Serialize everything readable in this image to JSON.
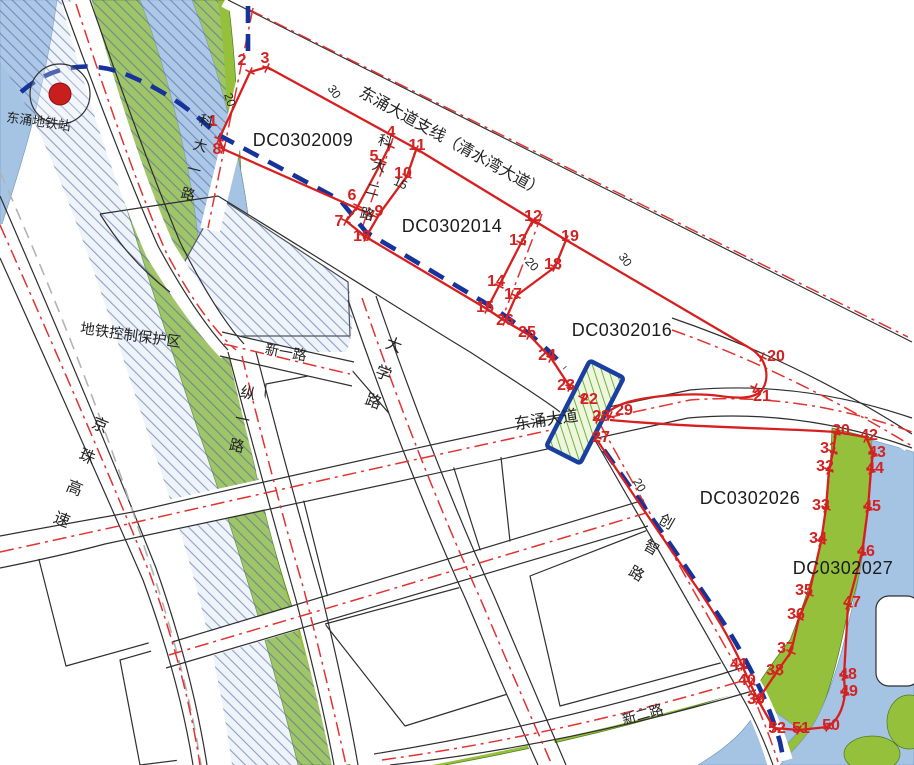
{
  "map_title": "东涌地块规划图",
  "colors": {
    "parcel_boundary_red": "#d81f1f",
    "centerline_red": "#e23232",
    "greenery": "#95c03c",
    "water": "#a5c4e3",
    "metro_blue": "#16339b",
    "hatch_blue": "#3d5a9e",
    "road_edge_black": "#2f2f2f"
  },
  "parcels": [
    {
      "id": "DC0302009",
      "x": 303,
      "y": 140
    },
    {
      "id": "DC0302014",
      "x": 452,
      "y": 226
    },
    {
      "id": "DC0302016",
      "x": 622,
      "y": 330
    },
    {
      "id": "DC0302026",
      "x": 750,
      "y": 498
    },
    {
      "id": "DC0302027",
      "x": 843,
      "y": 568
    }
  ],
  "points": [
    [
      1,
      219,
      139,
      213,
      121
    ],
    [
      2,
      250,
      72,
      242,
      60
    ],
    [
      3,
      267,
      68,
      265,
      58
    ],
    [
      4,
      390,
      146,
      391,
      132
    ],
    [
      5,
      382,
      161,
      374,
      156
    ],
    [
      6,
      358,
      206,
      352,
      195
    ],
    [
      7,
      346,
      221,
      339,
      221
    ],
    [
      8,
      223,
      149,
      217,
      149
    ],
    [
      9,
      372,
      215,
      379,
      211
    ],
    [
      10,
      407,
      176,
      403,
      173
    ],
    [
      11,
      416,
      150,
      417,
      145
    ],
    [
      12,
      533,
      222,
      533,
      216
    ],
    [
      13,
      521,
      243,
      518,
      240
    ],
    [
      14,
      499,
      286,
      496,
      281
    ],
    [
      15,
      487,
      309,
      485,
      307
    ],
    [
      16,
      366,
      237,
      362,
      236
    ],
    [
      17,
      516,
      296,
      513,
      294
    ],
    [
      18,
      555,
      267,
      553,
      264
    ],
    [
      19,
      566,
      240,
      570,
      236
    ],
    [
      20,
      762,
      357,
      776,
      356
    ],
    [
      21,
      755,
      388,
      762,
      396
    ],
    [
      22,
      583,
      398,
      589,
      399
    ],
    [
      23,
      570,
      387,
      566,
      385
    ],
    [
      24,
      551,
      358,
      547,
      355
    ],
    [
      25,
      529,
      335,
      527,
      332
    ],
    [
      26,
      505,
      321,
      505,
      320
    ],
    [
      27,
      597,
      437,
      601,
      437
    ],
    [
      28,
      598,
      419,
      601,
      416
    ],
    [
      29,
      610,
      416,
      624,
      410
    ],
    [
      30,
      836,
      433,
      841,
      430
    ],
    [
      31,
      833,
      452,
      829,
      448
    ],
    [
      32,
      829,
      470,
      825,
      466
    ],
    [
      33,
      826,
      508,
      821,
      505
    ],
    [
      34,
      821,
      542,
      818,
      538
    ],
    [
      35,
      809,
      594,
      804,
      590
    ],
    [
      36,
      799,
      618,
      796,
      614
    ],
    [
      37,
      791,
      652,
      786,
      648
    ],
    [
      38,
      776,
      673,
      775,
      670
    ],
    [
      39,
      758,
      700,
      756,
      699
    ],
    [
      40,
      751,
      683,
      747,
      680
    ],
    [
      41,
      743,
      666,
      739,
      664
    ],
    [
      42,
      866,
      438,
      869,
      435
    ],
    [
      43,
      873,
      454,
      877,
      452
    ],
    [
      44,
      871,
      470,
      875,
      468
    ],
    [
      45,
      868,
      508,
      872,
      506
    ],
    [
      46,
      862,
      553,
      866,
      551
    ],
    [
      47,
      848,
      605,
      852,
      602
    ],
    [
      48,
      844,
      676,
      848,
      674
    ],
    [
      49,
      845,
      693,
      849,
      691
    ],
    [
      50,
      828,
      727,
      831,
      725
    ],
    [
      51,
      799,
      730,
      801,
      728
    ],
    [
      52,
      774,
      728,
      777,
      728
    ]
  ],
  "road_labels_horizontal": [
    {
      "text": "东涌大道支线（清水湾大道）",
      "x": 449,
      "y": 146,
      "rot": 29,
      "size": 16
    },
    {
      "text": "新一路",
      "x": 285,
      "y": 357,
      "rot": 10,
      "size": 14
    },
    {
      "text": "东涌大道",
      "x": 547,
      "y": 425,
      "rot": -8,
      "size": 16
    },
    {
      "text": "新二路",
      "x": 644,
      "y": 719,
      "rot": -16,
      "size": 14
    },
    {
      "text": "地铁控制保护区",
      "x": 130,
      "y": 340,
      "rot": 8,
      "size": 14.5
    },
    {
      "text": "东涌地铁站",
      "x": 38,
      "y": 126,
      "rot": 8,
      "size": 13
    }
  ],
  "road_labels_vertical": [
    {
      "text": "科大一路",
      "x": 205,
      "y": 126,
      "rot": 14,
      "dy": 25,
      "size": 14
    },
    {
      "text": "科大二路",
      "x": 384,
      "y": 146,
      "rot": 14,
      "dy": 25,
      "size": 14
    },
    {
      "text": "大学路",
      "x": 392,
      "y": 350,
      "rot": 20,
      "dy": 30,
      "size": 16
    },
    {
      "text": "纵一路",
      "x": 247,
      "y": 398,
      "rot": 12,
      "dy": 27,
      "size": 15
    },
    {
      "text": "京珠高速",
      "x": 98,
      "y": 430,
      "rot": 22,
      "dy": 34,
      "size": 16
    },
    {
      "text": "创智路",
      "x": 664,
      "y": 526,
      "rot": 30,
      "dy": 30,
      "size": 15
    }
  ],
  "dimensions": [
    {
      "text": "20",
      "x": 226,
      "y": 101,
      "rot": 72
    },
    {
      "text": "30",
      "x": 331,
      "y": 94,
      "rot": 55
    },
    {
      "text": "15",
      "x": 399,
      "y": 187,
      "rot": 24
    },
    {
      "text": "20",
      "x": 529,
      "y": 267,
      "rot": 47
    },
    {
      "text": "30",
      "x": 622,
      "y": 262,
      "rot": 55
    },
    {
      "text": "20",
      "x": 636,
      "y": 487,
      "rot": 60
    }
  ],
  "station": {
    "label": "东涌地铁站",
    "x": 60,
    "y": 94
  }
}
